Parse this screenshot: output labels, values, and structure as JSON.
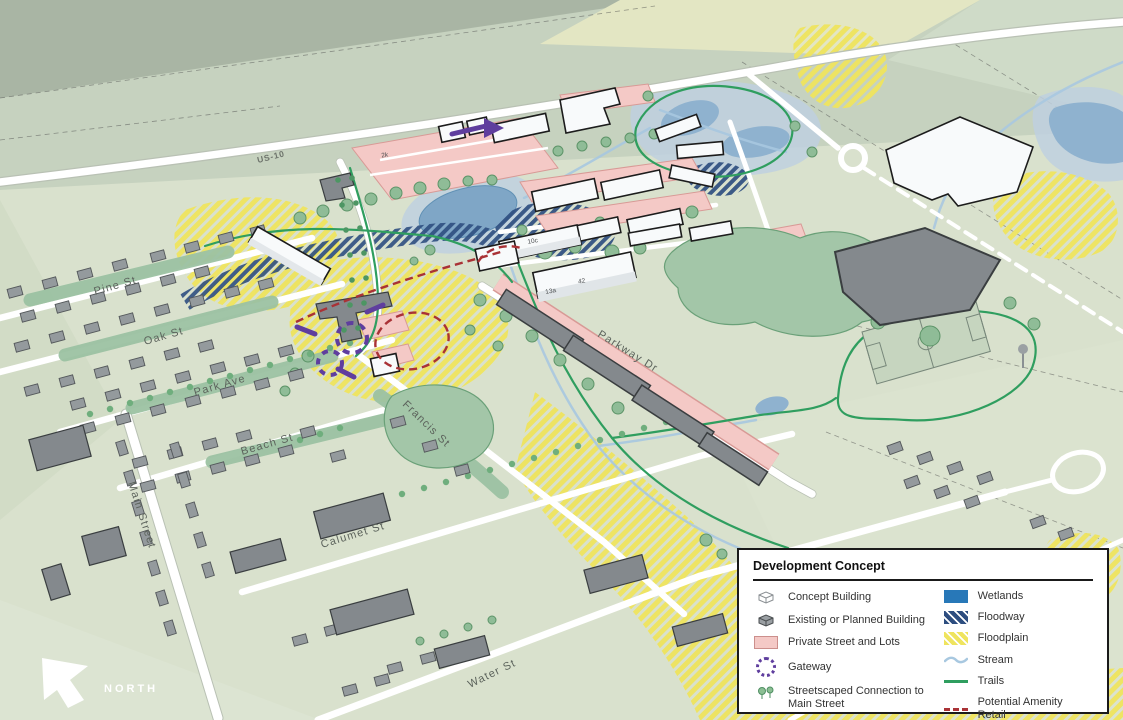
{
  "map": {
    "north_label": "NORTH",
    "highway": "US-10",
    "streets": {
      "pine": "Pine St",
      "oak": "Oak St",
      "park": "Park Ave",
      "beach": "Beach St",
      "main": "Main Street",
      "francis": "Francis St",
      "calumet": "Calumet St",
      "water": "Water St",
      "parkway": "Parkway Dr"
    },
    "building_labels": {
      "b1": "2k",
      "b2": "10c",
      "b3": "42",
      "b4": "13a"
    }
  },
  "legend": {
    "title": "Development Concept",
    "left": [
      {
        "label": "Concept Building"
      },
      {
        "label": "Existing or Planned Building"
      },
      {
        "label": "Private Street and Lots"
      },
      {
        "label": "Gateway"
      },
      {
        "label": "Streetscaped Connection to Main Street"
      }
    ],
    "right": [
      {
        "label": "Wetlands"
      },
      {
        "label": "Floodway"
      },
      {
        "label": "Floodplain"
      },
      {
        "label": "Stream"
      },
      {
        "label": "Trails"
      },
      {
        "label": "Potential Amenity Retail"
      }
    ]
  },
  "colors": {
    "wetland": "#2878b8",
    "floodway": "#2e4e80",
    "floodplain": "#efe45e",
    "stream": "#a8c8e0",
    "trail": "#2f9e5f",
    "gateway_purple": "#5f3e9e",
    "amenity_red": "#a93236",
    "private_street_pink": "#f4c9c6",
    "concept_building": "#f8fafb",
    "existing_building": "#8d9296",
    "pond": "#7fa6c6"
  }
}
